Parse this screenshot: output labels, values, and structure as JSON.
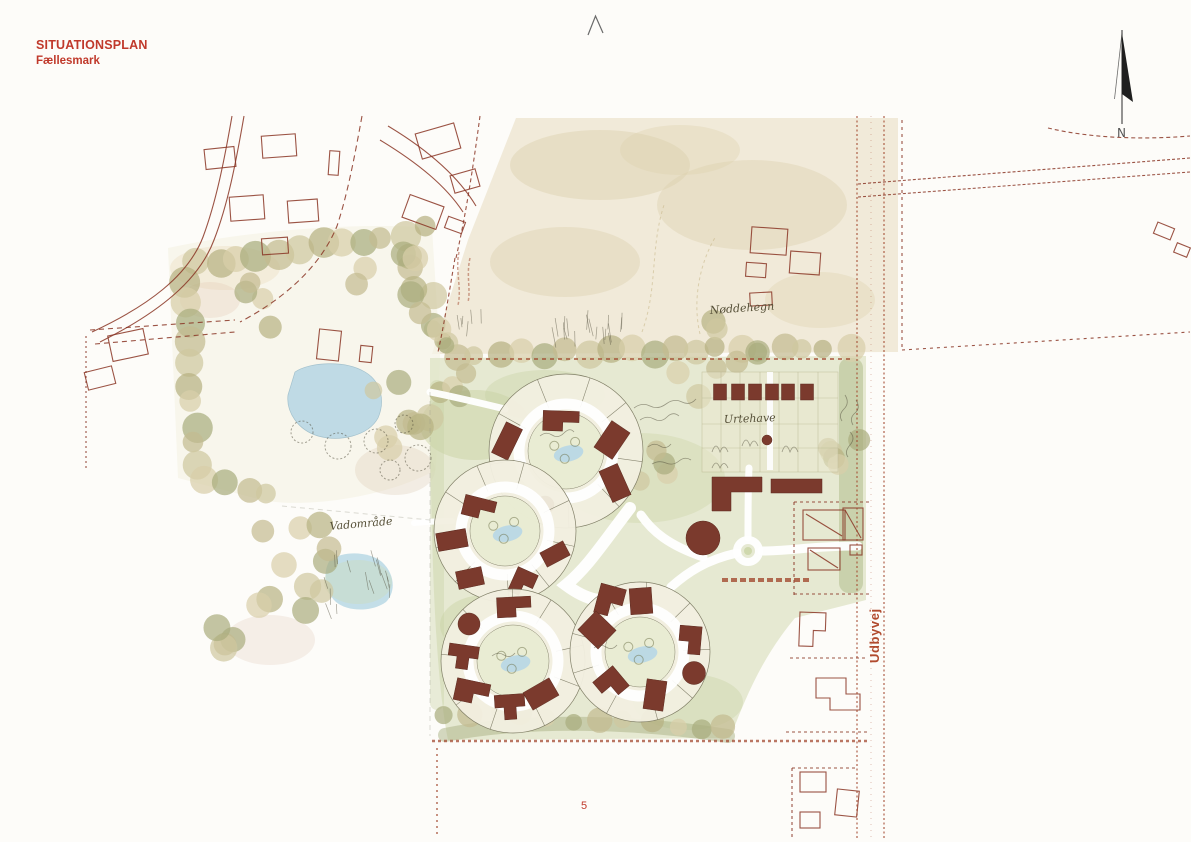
{
  "page": {
    "number": "5"
  },
  "header": {
    "title": "SITUATIONSPLAN",
    "subtitle": "Fællesmark"
  },
  "north_arrow": {
    "label": "N"
  },
  "road": {
    "label": "Udbyvej"
  },
  "annotations": [
    {
      "id": "noeddehegn",
      "text": "Nøddehegn"
    },
    {
      "id": "urtehave",
      "text": "Urtehave"
    },
    {
      "id": "vadomraade",
      "text": "Vadområde"
    }
  ],
  "colors": {
    "paper": "#fdfcf9",
    "accent_red": "#c0392b",
    "context_line": "#8a3525",
    "building": "#7b3a2d",
    "pond": "#b9d8e5",
    "meadow": "#dde2c2",
    "meadow2": "#c9d3a4",
    "field": "#ede5d1",
    "field_blotch": "#dcd0ad",
    "ink": "#4c4836"
  },
  "plan": {
    "tree_palette": [
      "#c3bb90",
      "#cfc7a0",
      "#b7b282",
      "#d8cfa9",
      "#a9ad7e"
    ],
    "tree_rows": [
      [
        455,
        354,
        848,
        348,
        19,
        11
      ],
      [
        197,
        264,
        424,
        230,
        12,
        12
      ],
      [
        186,
        282,
        197,
        466,
        10,
        12
      ],
      [
        208,
        478,
        268,
        494,
        4,
        11
      ],
      [
        447,
        712,
        726,
        728,
        12,
        10
      ]
    ],
    "tree_scatter": [
      [
        395,
        300,
        48,
        10,
        11
      ],
      [
        400,
        420,
        40,
        8,
        11
      ],
      [
        258,
        308,
        28,
        4,
        10
      ],
      [
        300,
        568,
        55,
        9,
        11
      ],
      [
        252,
        620,
        40,
        6,
        11
      ],
      [
        720,
        350,
        60,
        7,
        10
      ],
      [
        845,
        450,
        18,
        5,
        9
      ],
      [
        460,
        390,
        25,
        4,
        9
      ],
      [
        660,
        470,
        30,
        4,
        9
      ],
      [
        425,
        330,
        30,
        6,
        10
      ]
    ],
    "clusters": [
      {
        "cx": 566,
        "cy": 451,
        "r": 77,
        "ri": 38,
        "a0": -75,
        "spokes": 9,
        "buildings": [
          [
            "l",
            561,
            421,
            36,
            20,
            2
          ],
          [
            "r",
            507,
            441,
            18,
            34,
            26
          ],
          [
            "r",
            612,
            440,
            22,
            32,
            34
          ],
          [
            "r",
            615,
            483,
            20,
            34,
            -24
          ],
          [
            "c",
            545,
            505,
            18,
            18,
            0
          ]
        ]
      },
      {
        "cx": 505,
        "cy": 531,
        "r": 71,
        "ri": 35,
        "a0": -30,
        "spokes": 9,
        "buildings": [
          [
            "l",
            479,
            508,
            32,
            20,
            14
          ],
          [
            "r",
            452,
            540,
            18,
            30,
            80
          ],
          [
            "r",
            470,
            578,
            26,
            18,
            -12
          ],
          [
            "l",
            523,
            583,
            22,
            26,
            24
          ],
          [
            "r",
            555,
            554,
            16,
            26,
            62
          ]
        ]
      },
      {
        "cx": 513,
        "cy": 661,
        "r": 72,
        "ri": 36,
        "a0": -95,
        "spokes": 9,
        "buildings": [
          [
            "l",
            514,
            607,
            34,
            20,
            -3
          ],
          [
            "c",
            469,
            624,
            22,
            22,
            0
          ],
          [
            "t",
            463,
            657,
            30,
            24,
            8
          ],
          [
            "l",
            472,
            692,
            34,
            22,
            12
          ],
          [
            "t",
            510,
            707,
            30,
            25,
            -4
          ],
          [
            "r",
            541,
            694,
            30,
            20,
            -30
          ]
        ]
      },
      {
        "cx": 640,
        "cy": 652,
        "r": 70,
        "ri": 35,
        "a0": -120,
        "spokes": 9,
        "buildings": [
          [
            "l",
            610,
            601,
            26,
            30,
            15
          ],
          [
            "r",
            641,
            601,
            22,
            26,
            -4
          ],
          [
            "r",
            597,
            630,
            28,
            26,
            44
          ],
          [
            "l",
            690,
            640,
            28,
            22,
            95
          ],
          [
            "c",
            694,
            673,
            23,
            23,
            0
          ],
          [
            "r",
            655,
            695,
            20,
            30,
            8
          ],
          [
            "l",
            611,
            684,
            26,
            26,
            50
          ]
        ]
      }
    ],
    "sheds": [
      [
        720,
        392,
        13,
        16,
        0
      ],
      [
        738,
        392,
        13,
        16,
        0
      ],
      [
        755,
        392,
        13,
        16,
        0
      ],
      [
        772,
        392,
        13,
        16,
        0
      ],
      [
        788,
        392,
        13,
        16,
        0
      ],
      [
        807,
        392,
        13,
        16,
        0
      ]
    ],
    "context": {
      "buildings_topleft": [
        [
          220,
          158,
          30,
          20,
          -6
        ],
        [
          279,
          146,
          34,
          22,
          -4
        ],
        [
          334,
          163,
          10,
          24,
          4
        ],
        [
          438,
          141,
          40,
          26,
          -16
        ],
        [
          465,
          181,
          26,
          18,
          -16
        ],
        [
          423,
          212,
          36,
          24,
          20
        ],
        [
          455,
          225,
          18,
          12,
          20
        ],
        [
          247,
          208,
          34,
          24,
          -4
        ],
        [
          303,
          211,
          30,
          22,
          -4
        ],
        [
          275,
          246,
          26,
          16,
          -4
        ],
        [
          329,
          345,
          22,
          30,
          6
        ],
        [
          366,
          354,
          12,
          16,
          6
        ],
        [
          128,
          345,
          36,
          26,
          -12
        ],
        [
          100,
          378,
          28,
          18,
          -14
        ]
      ],
      "buildings_topright": [
        [
          769,
          241,
          36,
          26,
          4
        ],
        [
          805,
          263,
          30,
          22,
          4
        ],
        [
          756,
          270,
          20,
          14,
          4
        ],
        [
          761,
          299,
          22,
          13,
          -3
        ],
        [
          1164,
          231,
          18,
          12,
          22
        ],
        [
          1182,
          250,
          14,
          10,
          22
        ]
      ],
      "farm_buildings": [
        [
          824,
          525,
          42,
          30,
          0
        ],
        [
          853,
          524,
          20,
          32,
          0
        ],
        [
          824,
          559,
          32,
          22,
          0
        ],
        [
          856,
          550,
          12,
          10,
          0
        ]
      ],
      "buildings_bottomright": [
        [
          813,
          782,
          26,
          20,
          0
        ],
        [
          847,
          803,
          22,
          26,
          6
        ],
        [
          810,
          820,
          20,
          16,
          0
        ]
      ]
    }
  }
}
